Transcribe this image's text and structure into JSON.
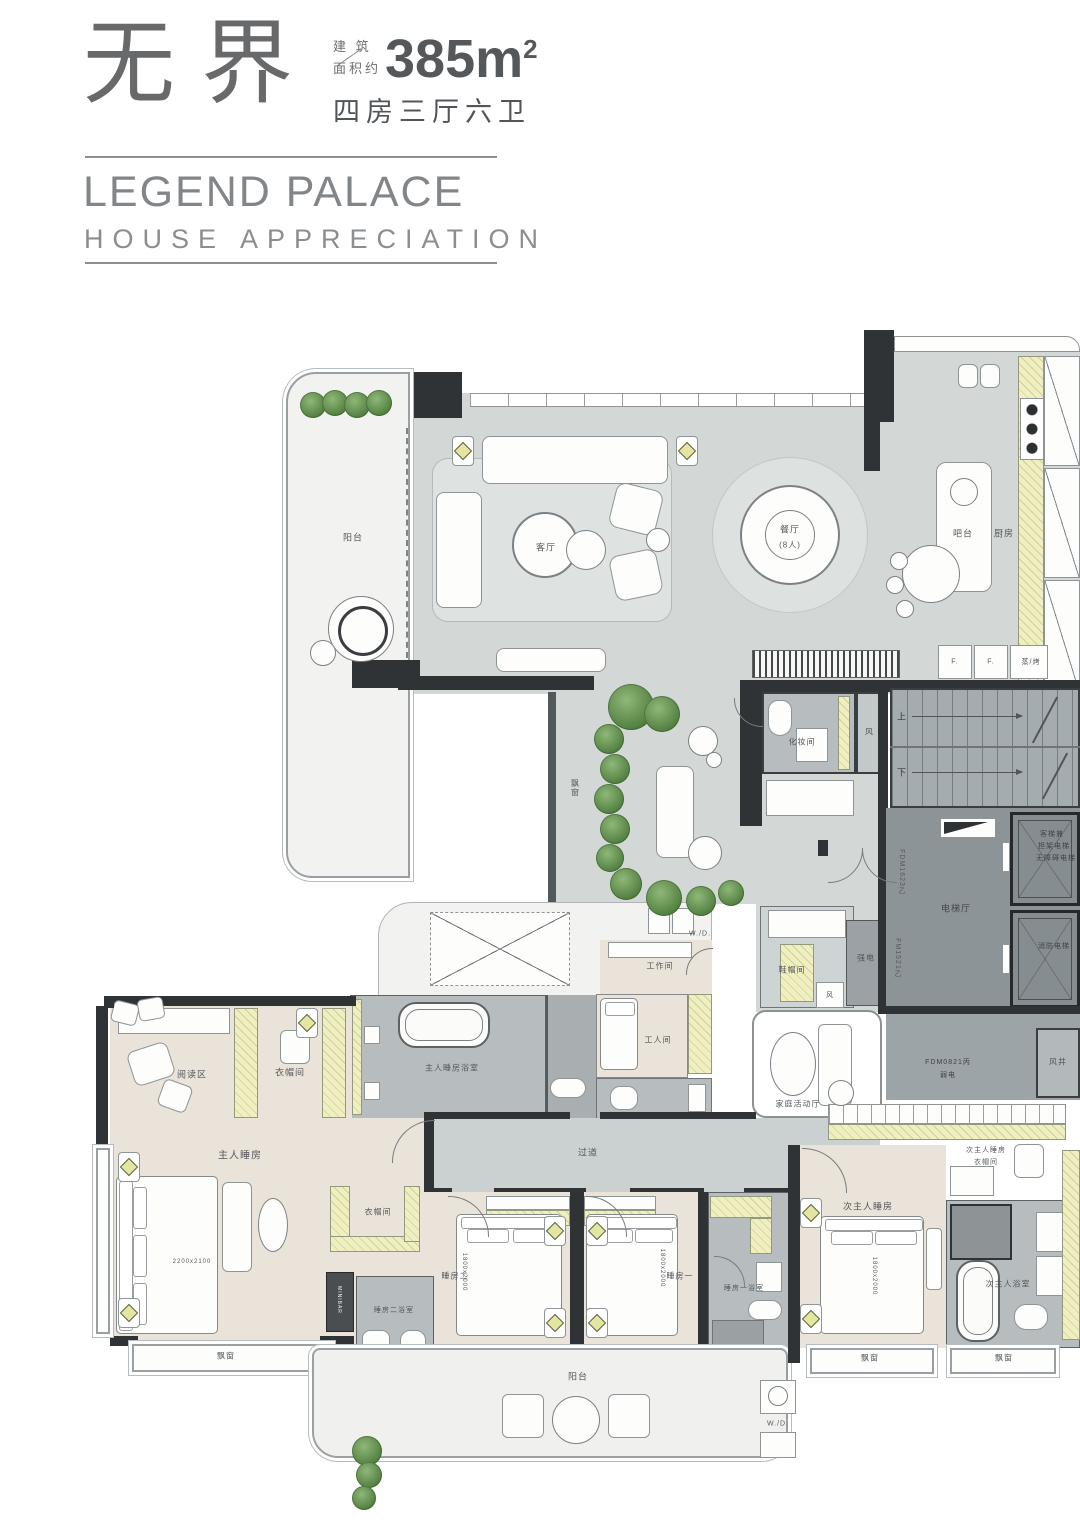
{
  "header": {
    "title": "无界",
    "area_label_1": "建 筑",
    "area_label_2": "面积约",
    "area_value": "385m",
    "area_sup": "2",
    "layout": "四房三厅六卫",
    "brand": "LEGEND PALACE",
    "subtitle": "HOUSE APPRECIATION"
  },
  "plan": {
    "balcony_top": "阳台",
    "living": "客厅",
    "dining_1": "餐厅",
    "dining_2": "(8人)",
    "bar": "吧台",
    "kitchen": "厨房",
    "fridge_1": "F.",
    "fridge_2": "F.",
    "steam_oven": "蒸/烤",
    "powder": "化妆间",
    "vent": "风",
    "vent_2": "风",
    "shaft": "风井",
    "up": "上",
    "down": "下",
    "elevator_hall": "电梯厅",
    "door_main": "FDM1623乙",
    "door_fire": "FM1521乙",
    "door_weak": "FDM0821丙",
    "weak_elec": "弱电",
    "strong_elec": "强电",
    "shoe_room": "鞋帽间",
    "elevator_1a": "客梯兼",
    "elevator_1b": "担架电梯",
    "elevator_1c": "无障碍电梯",
    "elevator_2": "消防电梯",
    "work_room": "工作间",
    "maid_room": "工人间",
    "wd_1": "W./D.",
    "wd_2": "W./D.",
    "master_bath": "主人睡房浴室",
    "reading": "阅读区",
    "closet_1": "衣帽间",
    "closet_2": "衣帽间",
    "master": "主人睡房",
    "master_bed_size": "2200x2100",
    "minibar": "MINIBAR",
    "bath_2": "睡房二浴室",
    "bay_1": "飘窗",
    "bay_2": "飘窗",
    "bay_3": "飘窗",
    "bay_4": "飘窗",
    "corridor": "过道",
    "bedroom_2": "睡房二",
    "bedroom_1": "睡房一",
    "bed_size_2": "1800x2000",
    "bed_size_1": "1800x2000",
    "bed_size_sm": "1800x2000",
    "bath_1": "睡房一浴室",
    "balcony_bottom": "阳台",
    "family_room": "家庭活动厅",
    "sm_closet_1": "次主人睡房",
    "sm_closet_2": "衣帽间",
    "second_master": "次主人睡房",
    "sm_bath": "次主人浴室"
  },
  "colors": {
    "floor": "#d3d8d7",
    "bedroom_floor": "#eae3da",
    "bath": "#b7bcbe",
    "hall": "#8d9497",
    "wall": "#2f3336",
    "cabinet_accent": "#f0efc0"
  }
}
